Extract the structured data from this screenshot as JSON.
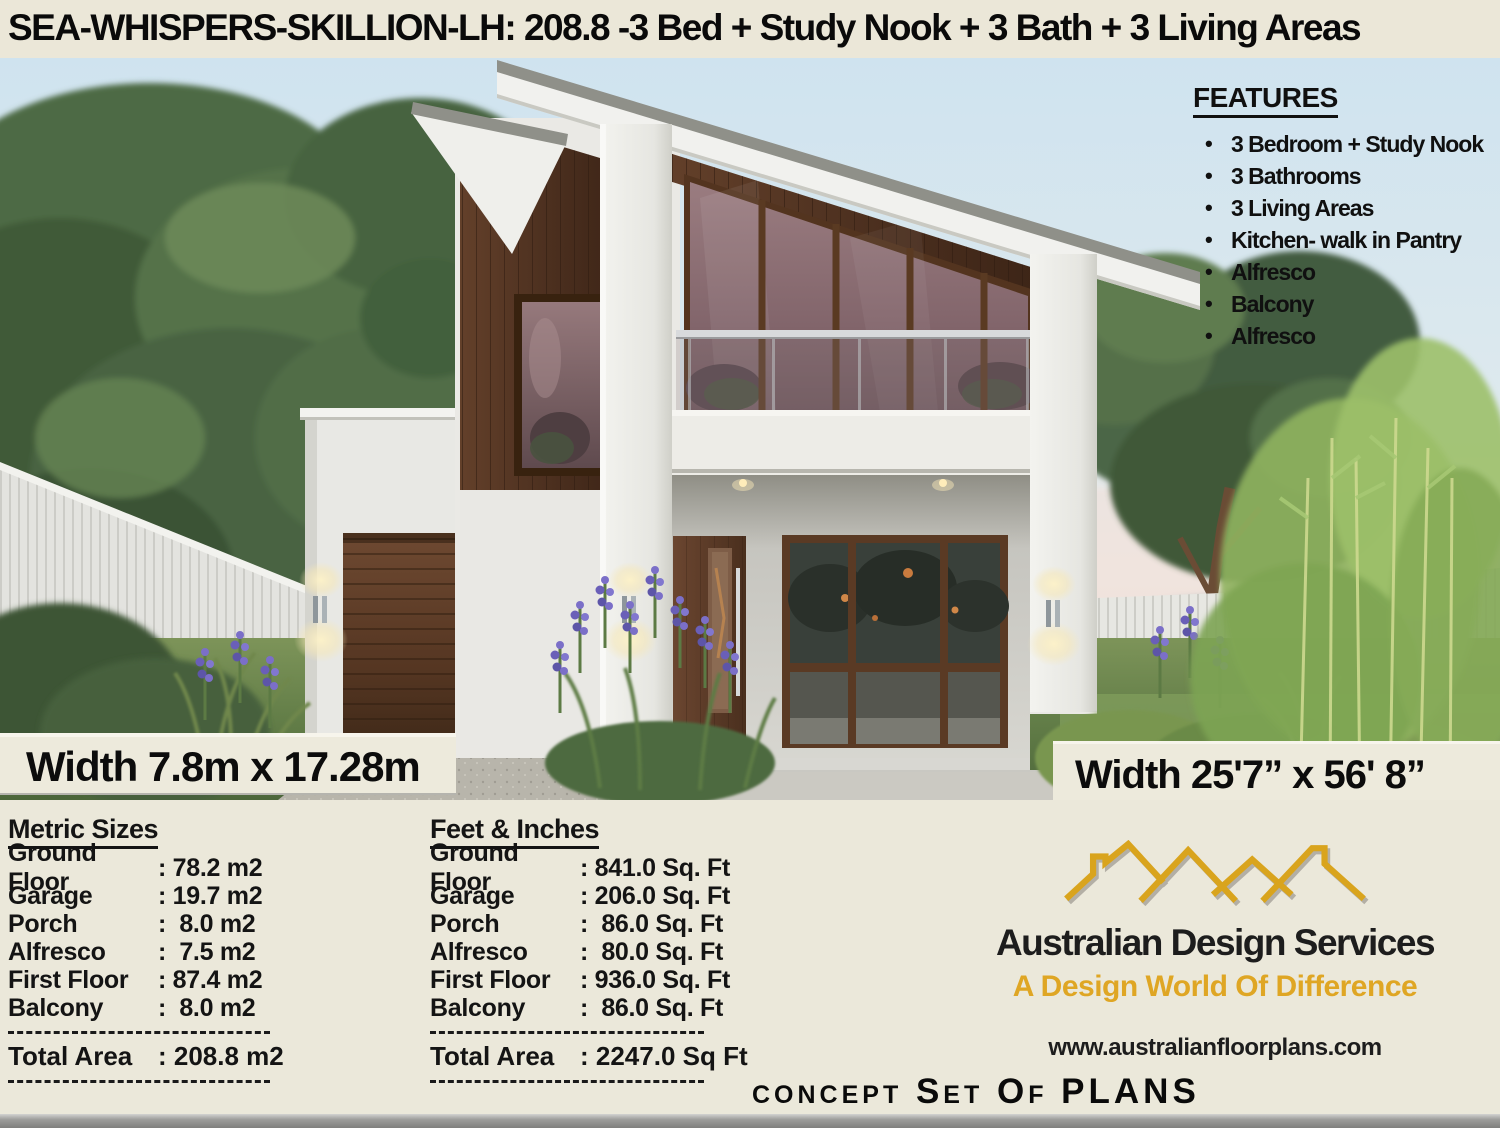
{
  "header": {
    "title": "SEA-WHISPERS-SKILLION-LH: 208.8 -3 Bed + Study Nook + 3 Bath + 3 Living Areas"
  },
  "features": {
    "title": "FEATURES",
    "bullet": "•",
    "items": [
      "3 Bedroom + Study Nook",
      "3 Bathrooms",
      "3 Living Areas",
      "Kitchen- walk in Pantry",
      "Alfresco",
      "Balcony",
      "Alfresco"
    ]
  },
  "dimensions": {
    "metric": "Width 7.8m x 17.28m",
    "imperial": "Width 25'7”  x 56' 8”"
  },
  "panel": {
    "metric": {
      "title": "Metric Sizes",
      "rows": [
        {
          "label": "Ground Floor",
          "value": ": 78.2 m2"
        },
        {
          "label": "Garage",
          "value": ": 19.7 m2"
        },
        {
          "label": "Porch",
          "value": ":  8.0 m2"
        },
        {
          "label": "Alfresco",
          "value": ":  7.5 m2"
        },
        {
          "label": "First Floor",
          "value": ": 87.4 m2"
        },
        {
          "label": "Balcony",
          "value": ":  8.0 m2"
        }
      ],
      "total_label": "Total Area",
      "total_value": ": 208.8 m2"
    },
    "imperial": {
      "title": "Feet & Inches",
      "rows": [
        {
          "label": "Ground Floor",
          "value": ": 841.0 Sq. Ft"
        },
        {
          "label": "Garage",
          "value": ": 206.0 Sq. Ft"
        },
        {
          "label": "Porch",
          "value": ":  86.0 Sq. Ft"
        },
        {
          "label": "Alfresco",
          "value": ":  80.0 Sq. Ft"
        },
        {
          "label": "First Floor",
          "value": ": 936.0 Sq. Ft"
        },
        {
          "label": "Balcony",
          "value": ":  86.0 Sq. Ft"
        }
      ],
      "total_label": "Total Area",
      "total_value": ": 2247.0 Sq Ft"
    }
  },
  "brand": {
    "name": "Australian Design Services",
    "tagline": "A Design World Of Difference",
    "website": "www.australianfloorplans.com",
    "plans_line": "concept Set Of PLANS",
    "gold": "#d9a41d"
  },
  "colors": {
    "panel_bg": "#ebe8da",
    "header_bg": "#ebe7d8",
    "wood": "#5a3a26",
    "sky": "#cfe3ef",
    "accent_gold": "#dfa624"
  }
}
